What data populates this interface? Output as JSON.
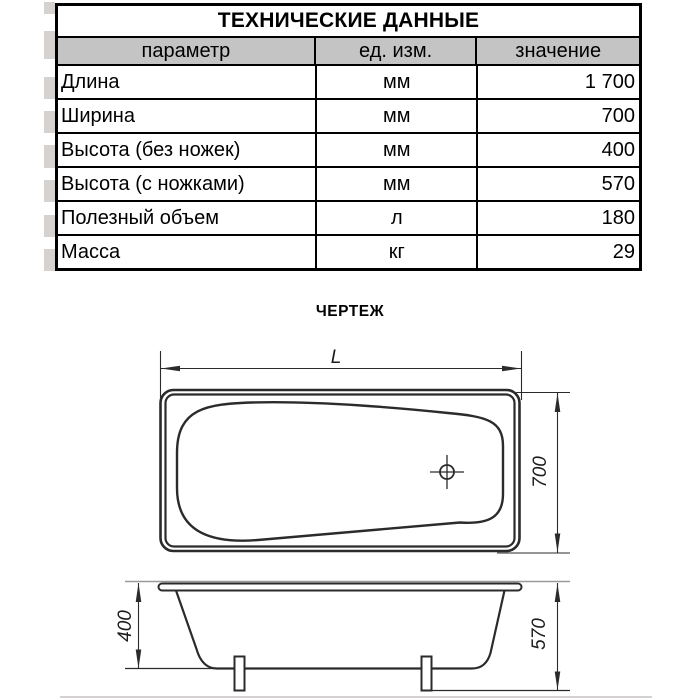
{
  "table": {
    "title": "ТЕХНИЧЕСКИЕ ДАННЫЕ",
    "columns": {
      "param": "параметр",
      "unit": "ед. изм.",
      "value": "значение"
    },
    "rows": [
      {
        "param": "Длина",
        "unit": "мм",
        "value": "1 700"
      },
      {
        "param": "Ширина",
        "unit": "мм",
        "value": "700"
      },
      {
        "param": "Высота (без ножек)",
        "unit": "мм",
        "value": "400"
      },
      {
        "param": "Высота (с ножками)",
        "unit": "мм",
        "value": "570"
      },
      {
        "param": "Полезный объем",
        "unit": "л",
        "value": "180"
      },
      {
        "param": "Масса",
        "unit": "кг",
        "value": "29"
      }
    ],
    "header_bg": "#c4c4c4"
  },
  "drawing": {
    "section_label": "ЧЕРТЕЖ",
    "top_view": {
      "length_label": "L",
      "width_label": "700"
    },
    "side_view": {
      "inner_height_label": "400",
      "total_height_label": "570"
    },
    "line_color": "#2b2b2b",
    "reference_line_color": "#9a9a9a"
  }
}
